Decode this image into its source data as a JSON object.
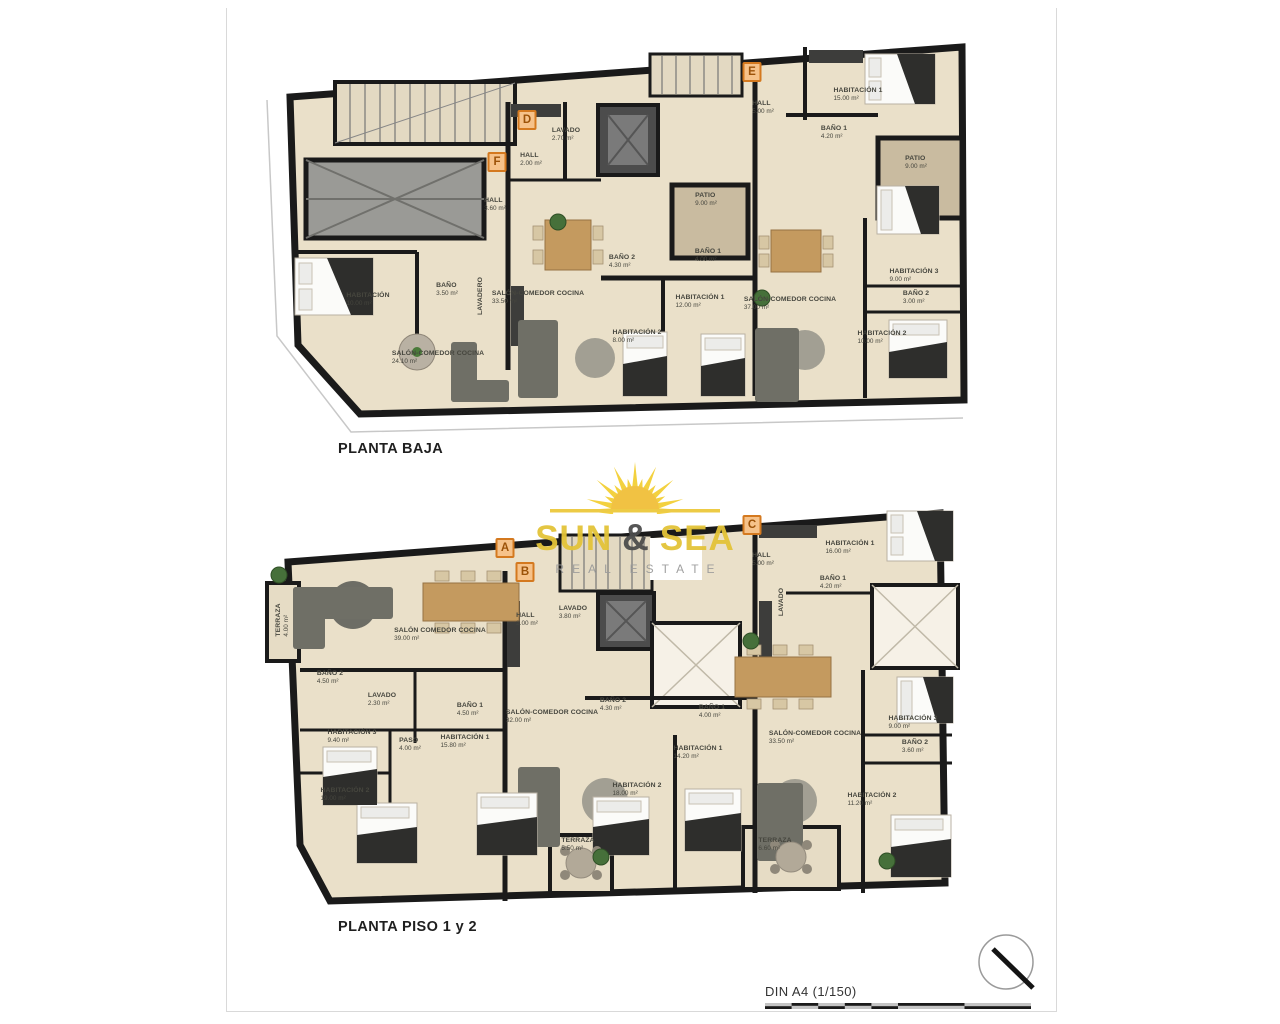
{
  "colors": {
    "wall": "#1a1a1a",
    "floor": "#eae0c9",
    "patio": "#c9bba0",
    "ramp": "#9a9a96",
    "badge_border": "#d4791f",
    "logo_gold": "#e3c338",
    "lightwell": "#f6f1e7"
  },
  "logo": {
    "word1": "SUN",
    "amp": "&",
    "word2": "SEA",
    "subtitle": "REAL ESTATE"
  },
  "plans": {
    "upper": {
      "title": "PLANTA BAJA",
      "badges": [
        {
          "letter": "F",
          "x": 232,
          "y": 122
        },
        {
          "letter": "D",
          "x": 262,
          "y": 80
        },
        {
          "letter": "E",
          "x": 487,
          "y": 32
        }
      ],
      "rooms": [
        {
          "name": "LAVADO",
          "area": "2.70 m²",
          "x": 301,
          "y": 95
        },
        {
          "name": "HALL",
          "area": "2.00 m²",
          "x": 266,
          "y": 120
        },
        {
          "name": "HALL",
          "area": "3.60 m²",
          "x": 230,
          "y": 165
        },
        {
          "name": "HALL",
          "area": "5.00 m²",
          "x": 498,
          "y": 68
        },
        {
          "name": "HABITACIÓN",
          "area": "10.00 m²",
          "x": 103,
          "y": 260
        },
        {
          "name": "BAÑO",
          "area": "3.50 m²",
          "x": 182,
          "y": 250
        },
        {
          "name": "LAVADERO",
          "area": "",
          "x": 216,
          "y": 256,
          "cls": "vertical"
        },
        {
          "name": "SALÓN-COMEDOR COCINA",
          "area": "24.10 m²",
          "x": 173,
          "y": 318
        },
        {
          "name": "SALÓN-COMEDOR COCINA",
          "area": "33.50 m²",
          "x": 273,
          "y": 258
        },
        {
          "name": "BAÑO 2",
          "area": "4.30 m²",
          "x": 357,
          "y": 222
        },
        {
          "name": "BAÑO 1",
          "area": "4.00 m²",
          "x": 443,
          "y": 216
        },
        {
          "name": "HABITACIÓN 1",
          "area": "12.00 m²",
          "x": 435,
          "y": 262
        },
        {
          "name": "HABITACIÓN 2",
          "area": "8.00 m²",
          "x": 372,
          "y": 297
        },
        {
          "name": "PATIO",
          "area": "9.00 m²",
          "x": 441,
          "y": 160
        },
        {
          "name": "HABITACIÓN 1",
          "area": "15.00 m²",
          "x": 593,
          "y": 55
        },
        {
          "name": "BAÑO 1",
          "area": "4.20 m²",
          "x": 569,
          "y": 93
        },
        {
          "name": "PATIO",
          "area": "9.00 m²",
          "x": 651,
          "y": 123
        },
        {
          "name": "SALÓN-COMEDOR COCINA",
          "area": "37.00 m²",
          "x": 525,
          "y": 264
        },
        {
          "name": "HABITACIÓN 3",
          "area": "9.00 m²",
          "x": 649,
          "y": 236
        },
        {
          "name": "BAÑO 2",
          "area": "3.00 m²",
          "x": 651,
          "y": 258
        },
        {
          "name": "HABITACIÓN 2",
          "area": "10.00 m²",
          "x": 617,
          "y": 298
        }
      ]
    },
    "lower": {
      "title": "PLANTA PISO 1 y 2",
      "badges": [
        {
          "letter": "A",
          "x": 240,
          "y": 43
        },
        {
          "letter": "B",
          "x": 260,
          "y": 67
        },
        {
          "letter": "C",
          "x": 487,
          "y": 20
        }
      ],
      "rooms": [
        {
          "name": "TERRAZA",
          "area": "4.00 m²",
          "x": 18,
          "y": 115,
          "cls": "vertical"
        },
        {
          "name": "SALÓN COMEDOR COCINA",
          "area": "39.00 m²",
          "x": 175,
          "y": 130
        },
        {
          "name": "HALL",
          "area": "2.00 m²",
          "x": 262,
          "y": 115
        },
        {
          "name": "LAVADO",
          "area": "3.80 m²",
          "x": 308,
          "y": 108
        },
        {
          "name": "HALL",
          "area": "5.00 m²",
          "x": 498,
          "y": 55
        },
        {
          "name": "HABITACIÓN 1",
          "area": "16.00 m²",
          "x": 585,
          "y": 43
        },
        {
          "name": "BAÑO 1",
          "area": "4.20 m²",
          "x": 568,
          "y": 78
        },
        {
          "name": "LAVADO",
          "area": "",
          "x": 517,
          "y": 97,
          "cls": "vertical"
        },
        {
          "name": "BAÑO 2",
          "area": "4.50 m²",
          "x": 65,
          "y": 173
        },
        {
          "name": "LAVADO",
          "area": "2.30 m²",
          "x": 117,
          "y": 195
        },
        {
          "name": "BAÑO 1",
          "area": "4.50 m²",
          "x": 205,
          "y": 205
        },
        {
          "name": "SALÓN-COMEDOR COCINA",
          "area": "32.00 m²",
          "x": 287,
          "y": 212
        },
        {
          "name": "BAÑO 2",
          "area": "4.30 m²",
          "x": 348,
          "y": 200
        },
        {
          "name": "BAÑO 1",
          "area": "4.00 m²",
          "x": 447,
          "y": 207
        },
        {
          "name": "HABITACIÓN 3",
          "area": "9.40 m²",
          "x": 87,
          "y": 232
        },
        {
          "name": "PASO",
          "area": "4.00 m²",
          "x": 145,
          "y": 240
        },
        {
          "name": "HABITACIÓN 1",
          "area": "15.80 m²",
          "x": 200,
          "y": 237
        },
        {
          "name": "HABITACIÓN 1",
          "area": "14.20 m²",
          "x": 433,
          "y": 248
        },
        {
          "name": "SALÓN-COMEDOR COCINA",
          "area": "33.50 m²",
          "x": 550,
          "y": 233
        },
        {
          "name": "HABITACIÓN 3",
          "area": "9.00 m²",
          "x": 648,
          "y": 218
        },
        {
          "name": "BAÑO 2",
          "area": "3.60 m²",
          "x": 650,
          "y": 242
        },
        {
          "name": "HABITACIÓN 2",
          "area": "19.00 m²",
          "x": 80,
          "y": 290
        },
        {
          "name": "HABITACIÓN 2",
          "area": "18.00 m²",
          "x": 372,
          "y": 285
        },
        {
          "name": "HABITACIÓN 2",
          "area": "11.20 m²",
          "x": 607,
          "y": 295
        },
        {
          "name": "TERRAZA",
          "area": "5.50 m²",
          "x": 313,
          "y": 340
        },
        {
          "name": "TERRAZA",
          "area": "6.60 m²",
          "x": 510,
          "y": 340
        }
      ]
    }
  },
  "scalebar": {
    "label": "DIN A4 (1/150)",
    "ticks": [
      {
        "t": "0",
        "x": 0
      },
      {
        "t": "1",
        "x": 27
      },
      {
        "t": "2",
        "x": 53
      },
      {
        "t": "3",
        "x": 80
      },
      {
        "t": "4",
        "x": 106
      },
      {
        "t": "5",
        "x": 133
      },
      {
        "t": "10",
        "x": 266
      }
    ]
  }
}
